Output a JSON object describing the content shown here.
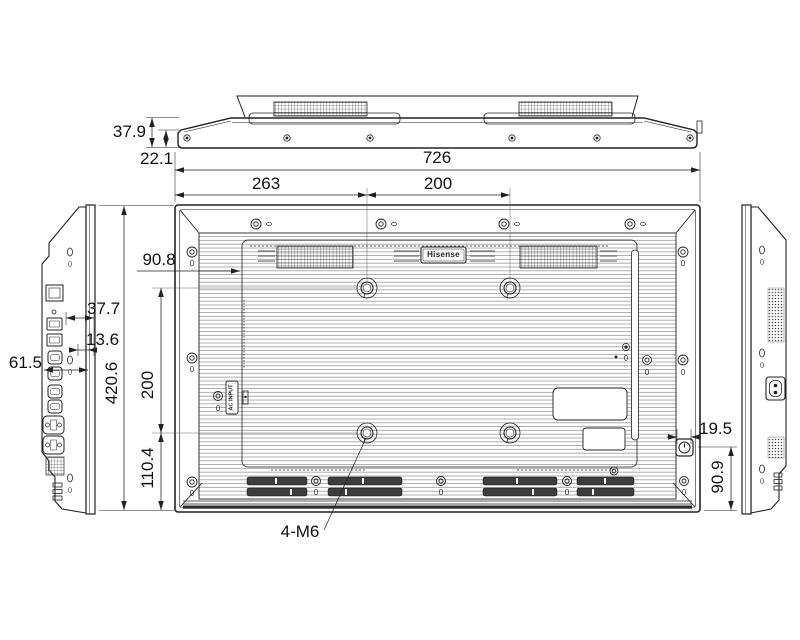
{
  "page": {
    "background": "#ffffff",
    "line_color": "#222222"
  },
  "drawing": {
    "brand_label": "Hisense",
    "ac_input_label": "AC INPUT",
    "vesa_callout": "4-M6",
    "dims": {
      "top_thickness": "37.9",
      "bezel_thickness": "22.1",
      "overall_width": "726",
      "vesa_offset_left": "263",
      "vesa_spacing_h": "200",
      "vesa_offset_top": "90.8",
      "port_inset_a": "37.7",
      "port_inset_b": "13.6",
      "side_depth": "61.5",
      "overall_height": "420.6",
      "vesa_spacing_v": "200",
      "vesa_offset_bottom": "110.4",
      "power_inset": "19.5",
      "power_offset_bottom": "90.9"
    }
  }
}
